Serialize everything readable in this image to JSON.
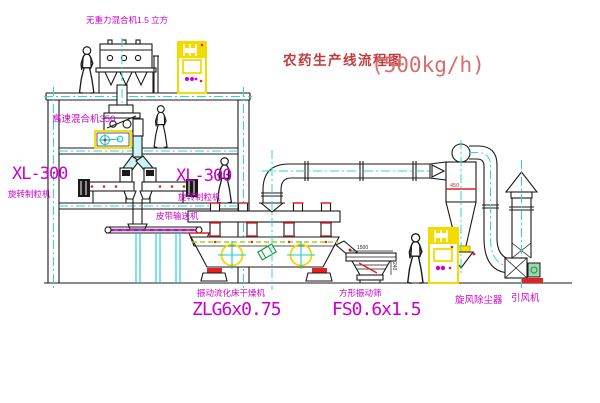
{
  "title": {
    "name": "农药生产线流程图",
    "capacity": "(500kg/h)"
  },
  "equipment_labels": {
    "gravity_mixer": "无重力混合机1.5 立方",
    "high_speed_mixer": "高速混合机350",
    "granulator_left": {
      "model": "XL-300",
      "name": "旋转制粒机"
    },
    "granulator_right": {
      "model": "XL-300",
      "name": "旋转制粒机"
    },
    "belt_conveyor": "皮带输送机",
    "fluid_bed_dryer": {
      "name": "振动流化床干燥机",
      "model": "ZLG6x0.75"
    },
    "vibrating_screen": {
      "name": "方形振动筛",
      "model": "FS0.6x1.5"
    },
    "cyclone": "旋风除尘器",
    "draft_fan": "引风机"
  },
  "dimensions": {
    "cyclone_band": "450",
    "screen_width": "1500",
    "screen_height": "240"
  },
  "colors": {
    "line": "#1a1a1a",
    "cyan": "#19c9cf",
    "magenta": "#cc00cc",
    "yellow": "#f2dc00",
    "red": "#e42020",
    "title_red": "#c23b3b",
    "background": "#ffffff"
  }
}
